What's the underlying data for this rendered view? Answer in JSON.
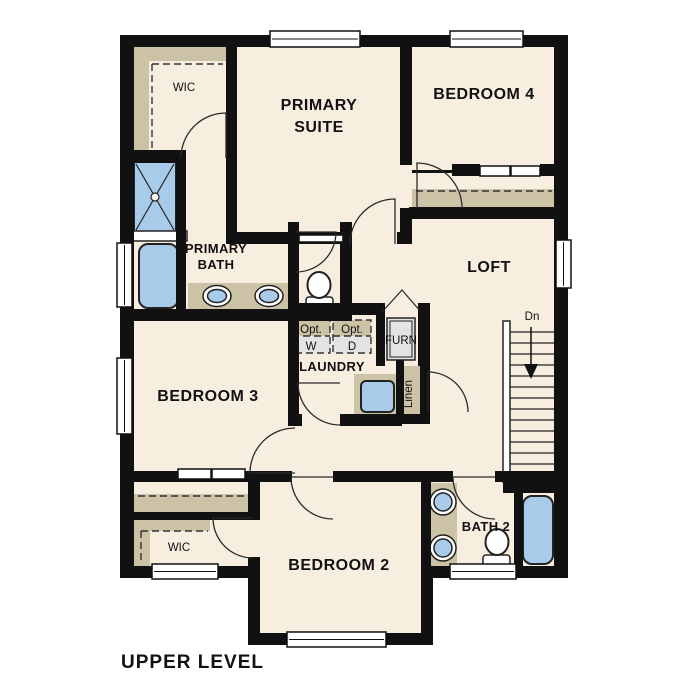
{
  "title": "UPPER LEVEL",
  "colors": {
    "walls": "#111111",
    "floor": "#f8eee0",
    "closet_shade": "#ccc2a6",
    "fixture_blue": "#a7cbe9",
    "appliance_gray": "#e3e3e3",
    "window_white": "#ffffff"
  },
  "rooms": {
    "wic_upper": {
      "label": "WIC"
    },
    "primary_suite": {
      "line1": "PRIMARY",
      "line2": "SUITE"
    },
    "bedroom4": {
      "label": "BEDROOM 4"
    },
    "primary_bath": {
      "line1": "PRIMARY",
      "line2": "BATH"
    },
    "loft": {
      "label": "LOFT"
    },
    "bedroom3": {
      "label": "BEDROOM 3"
    },
    "laundry": {
      "label": "LAUNDRY"
    },
    "furnace": {
      "label": "FURN"
    },
    "linen": {
      "label": "Linen"
    },
    "bedroom2": {
      "label": "BEDROOM 2"
    },
    "bath2": {
      "label": "BATH 2"
    },
    "wic_lower": {
      "label": "WIC"
    }
  },
  "laundry_options": {
    "washer": {
      "line1": "Opt.",
      "line2": "W"
    },
    "dryer": {
      "line1": "Opt.",
      "line2": "D"
    }
  },
  "stairs": {
    "direction_label": "Dn"
  }
}
